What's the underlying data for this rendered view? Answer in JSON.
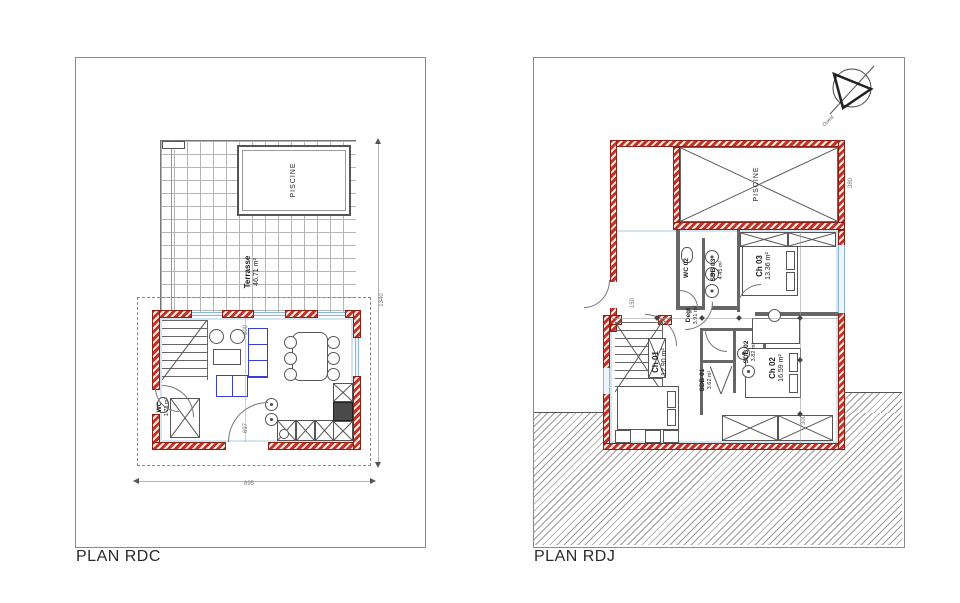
{
  "colors": {
    "wall_red": "#c13327",
    "wall_edge": "#8e1d12",
    "window_blue": "#cfe2ee",
    "line_gray": "#555555",
    "hatch_gray": "#999999",
    "sofa_blue": "#3340c8",
    "grid_gray": "#b5b5b5"
  },
  "plan_rdc": {
    "title": "PLAN RDC",
    "pool": {
      "label": "PISCINE"
    },
    "terrasse": {
      "name": "Terrasse",
      "area": "46.71 m²"
    },
    "sejour": {
      "name": "Séjour",
      "area": "35.82 m²"
    },
    "wc": {
      "name": "WC",
      "area": "1.73 m²"
    },
    "dims": {
      "right": "1340",
      "bottom": "895",
      "inner_top": "800",
      "inner_bottom": "697"
    }
  },
  "plan_rdj": {
    "title": "PLAN RDJ",
    "pool": {
      "label": "PISCINE"
    },
    "compass": {
      "label": "Ouest"
    },
    "rooms": {
      "wc02": {
        "name": "WC 02",
        "area": ""
      },
      "sdb03": {
        "name": "SDB 03",
        "area": "4.45 m²"
      },
      "ch03": {
        "name": "Ch 03",
        "area": "13.36 m²"
      },
      "degt": {
        "name": "Degt",
        "area": "3.91 m²"
      },
      "ch01": {
        "name": "Ch 01",
        "area": "12.90 m²"
      },
      "sdb02": {
        "name": "SDB 02",
        "area": "3.82 m²"
      },
      "sdb01": {
        "name": "SDB 01",
        "area": "3.62 m²"
      },
      "ch02": {
        "name": "Ch 02",
        "area": "16.59 m²"
      }
    },
    "dims": {
      "pool_right": "380",
      "lower": "300",
      "mid": "150"
    }
  }
}
